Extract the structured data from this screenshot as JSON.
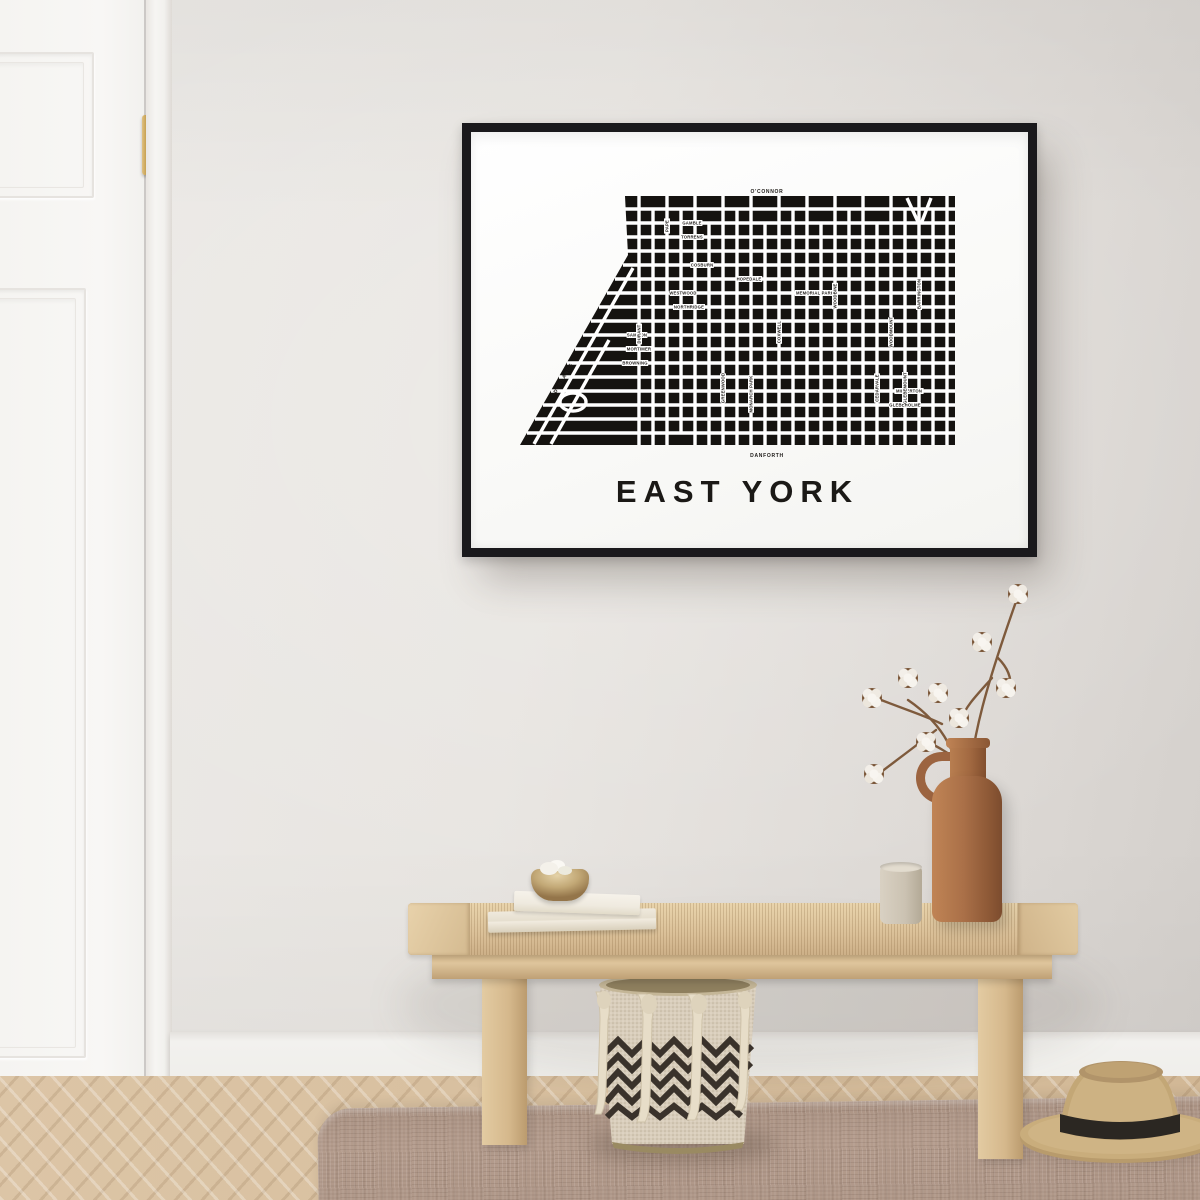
{
  "poster": {
    "title": "EAST YORK",
    "colors": {
      "frame": "#1a191c",
      "paper": "#fafaf8",
      "map_ink": "#151310",
      "street": "#ffffff",
      "label_ink": "#262320"
    },
    "map": {
      "width": 441,
      "height": 277,
      "street_width": 3.4,
      "outline": [
        [
          108,
          14
        ],
        [
          438,
          14
        ],
        [
          438,
          263
        ],
        [
          3,
          263
        ],
        [
          111,
          73
        ]
      ],
      "outer_labels": [
        {
          "t": "O'CONNOR",
          "x": 250,
          "y": 9,
          "rot": 0
        },
        {
          "t": "DANFORTH",
          "x": 250,
          "y": 273,
          "rot": 0
        },
        {
          "t": "DONLANDS",
          "x": 46,
          "y": 196,
          "rot": -60
        },
        {
          "t": "MAIN",
          "x": 444,
          "y": 150,
          "rot": 90
        }
      ],
      "h_streets": [
        {
          "y": 27,
          "x1": 108,
          "x2": 438
        },
        {
          "y": 41,
          "x1": 108,
          "x2": 438
        },
        {
          "y": 55,
          "x1": 108,
          "x2": 438
        },
        {
          "y": 69,
          "x1": 110,
          "x2": 438
        },
        {
          "y": 83,
          "x1": 106,
          "x2": 438
        },
        {
          "y": 97,
          "x1": 98,
          "x2": 438
        },
        {
          "y": 111,
          "x1": 90,
          "x2": 438
        },
        {
          "y": 125,
          "x1": 82,
          "x2": 438
        },
        {
          "y": 139,
          "x1": 74,
          "x2": 438
        },
        {
          "y": 153,
          "x1": 66,
          "x2": 438
        },
        {
          "y": 167,
          "x1": 58,
          "x2": 438
        },
        {
          "y": 181,
          "x1": 50,
          "x2": 438
        },
        {
          "y": 195,
          "x1": 42,
          "x2": 438
        },
        {
          "y": 209,
          "x1": 34,
          "x2": 438
        },
        {
          "y": 223,
          "x1": 26,
          "x2": 438
        },
        {
          "y": 237,
          "x1": 18,
          "x2": 438
        },
        {
          "y": 251,
          "x1": 10,
          "x2": 438
        }
      ],
      "v_streets": [
        {
          "x": 122,
          "y1": 14,
          "y2": 263
        },
        {
          "x": 136,
          "y1": 27,
          "y2": 263
        },
        {
          "x": 150,
          "y1": 14,
          "y2": 263
        },
        {
          "x": 164,
          "y1": 27,
          "y2": 251
        },
        {
          "x": 178,
          "y1": 14,
          "y2": 263
        },
        {
          "x": 192,
          "y1": 41,
          "y2": 263
        },
        {
          "x": 206,
          "y1": 14,
          "y2": 263
        },
        {
          "x": 220,
          "y1": 27,
          "y2": 263
        },
        {
          "x": 234,
          "y1": 14,
          "y2": 263
        },
        {
          "x": 248,
          "y1": 41,
          "y2": 263
        },
        {
          "x": 262,
          "y1": 14,
          "y2": 263
        },
        {
          "x": 276,
          "y1": 27,
          "y2": 263
        },
        {
          "x": 290,
          "y1": 14,
          "y2": 263
        },
        {
          "x": 304,
          "y1": 41,
          "y2": 263
        },
        {
          "x": 318,
          "y1": 14,
          "y2": 263
        },
        {
          "x": 332,
          "y1": 27,
          "y2": 263
        },
        {
          "x": 346,
          "y1": 14,
          "y2": 263
        },
        {
          "x": 360,
          "y1": 41,
          "y2": 263
        },
        {
          "x": 374,
          "y1": 14,
          "y2": 263
        },
        {
          "x": 388,
          "y1": 27,
          "y2": 263
        },
        {
          "x": 402,
          "y1": 14,
          "y2": 263
        },
        {
          "x": 416,
          "y1": 27,
          "y2": 263
        },
        {
          "x": 430,
          "y1": 14,
          "y2": 263
        }
      ],
      "diagonals": [
        {
          "x1": 17,
          "y1": 262,
          "x2": 116,
          "y2": 86
        },
        {
          "x1": 34,
          "y1": 262,
          "x2": 92,
          "y2": 158
        },
        {
          "x1": 390,
          "y1": 16,
          "x2": 402,
          "y2": 42
        },
        {
          "x1": 414,
          "y1": 16,
          "x2": 404,
          "y2": 42
        }
      ],
      "loops": [
        {
          "cx": 56,
          "cy": 220,
          "rx": 13,
          "ry": 9
        }
      ],
      "street_labels": [
        {
          "t": "GAMBLE",
          "x": 175,
          "y": 41,
          "rot": 0
        },
        {
          "t": "TORRENS",
          "x": 175,
          "y": 55,
          "rot": 0
        },
        {
          "t": "COSBURN",
          "x": 185,
          "y": 83,
          "rot": 0
        },
        {
          "t": "HOPEDALE",
          "x": 232,
          "y": 97,
          "rot": 0
        },
        {
          "t": "WESTWOOD",
          "x": 166,
          "y": 111,
          "rot": 0
        },
        {
          "t": "MEMORIAL PARK",
          "x": 298,
          "y": 111,
          "rot": 0
        },
        {
          "t": "NORTHRIDGE",
          "x": 172,
          "y": 125,
          "rot": 0
        },
        {
          "t": "SAMMON",
          "x": 120,
          "y": 153,
          "rot": 0
        },
        {
          "t": "MORTIMER",
          "x": 122,
          "y": 167,
          "rot": 0
        },
        {
          "t": "BROWNING",
          "x": 118,
          "y": 181,
          "rot": 0
        },
        {
          "t": "MILVERTON",
          "x": 392,
          "y": 209,
          "rot": 0
        },
        {
          "t": "GLEBEHOLME",
          "x": 388,
          "y": 223,
          "rot": 0
        },
        {
          "t": "DURANT",
          "x": 122,
          "y": 152,
          "rot": -90
        },
        {
          "t": "PAPE",
          "x": 150,
          "y": 44,
          "rot": -90
        },
        {
          "t": "GREENWOOD",
          "x": 206,
          "y": 206,
          "rot": -90
        },
        {
          "t": "MONARCH PARK",
          "x": 234,
          "y": 212,
          "rot": -90
        },
        {
          "t": "COXWELL",
          "x": 262,
          "y": 150,
          "rot": -90
        },
        {
          "t": "WOODBINE",
          "x": 318,
          "y": 114,
          "rot": -90
        },
        {
          "t": "CEDARVALE",
          "x": 360,
          "y": 206,
          "rot": -90
        },
        {
          "t": "WOODMOUNT",
          "x": 374,
          "y": 150,
          "rot": -90
        },
        {
          "t": "GLEBEMOUNT",
          "x": 388,
          "y": 206,
          "rot": -90
        },
        {
          "t": "BARRINGTON",
          "x": 402,
          "y": 112,
          "rot": -90
        }
      ]
    }
  },
  "scene": {
    "colors": {
      "wall": "#e8e5e1",
      "door": "#f7f6f3",
      "handle_gold": "#c8a254",
      "bench_wood": "#dcc29a",
      "clay_vase": "#aa7048",
      "mug_greige": "#cbc2b2",
      "book_cream": "#efe9dd",
      "basket_cream": "#d8cdbb",
      "basket_dark": "#3a322b",
      "rug_taupe": "#b49c8d",
      "straw": "#c7ab7a",
      "cotton_white": "#f3efe9",
      "stem_brown": "#7e5a3c"
    },
    "objects": [
      "paneled-door",
      "brass-door-handle",
      "black-picture-frame",
      "east-york-map-poster",
      "wooden-bench",
      "stacked-books",
      "brass-trinket-bowl",
      "ceramic-mug",
      "clay-jug-vase",
      "cotton-branches",
      "chevron-tassel-basket",
      "straw-hat",
      "woven-rug",
      "herringbone-floor",
      "baseboard"
    ]
  }
}
